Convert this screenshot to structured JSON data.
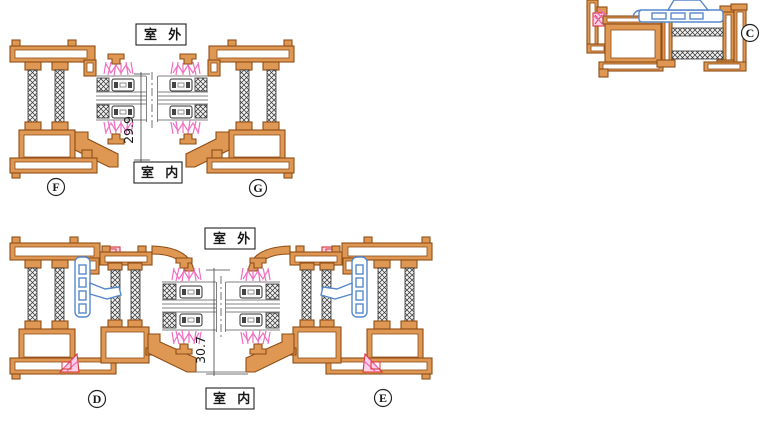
{
  "colors": {
    "al_fill": "#DF9854",
    "al_stroke": "#8F4E16",
    "seal_pink": "#F06EC0",
    "accent_red": "#D93434",
    "hw_blue": "#5588CC",
    "glass_gray": "#808080",
    "ink": "#1A1A1A"
  },
  "views": {
    "top_section": {
      "outdoor": "室 外",
      "indoor": "室 内",
      "dimension": "29.9",
      "left_tag": "F",
      "right_tag": "G"
    },
    "bottom_section": {
      "outdoor": "室 外",
      "indoor": "室 内",
      "dimension": "30.7",
      "left_tag": "D",
      "right_tag": "E"
    },
    "corner_section": {
      "tag": "C"
    }
  }
}
